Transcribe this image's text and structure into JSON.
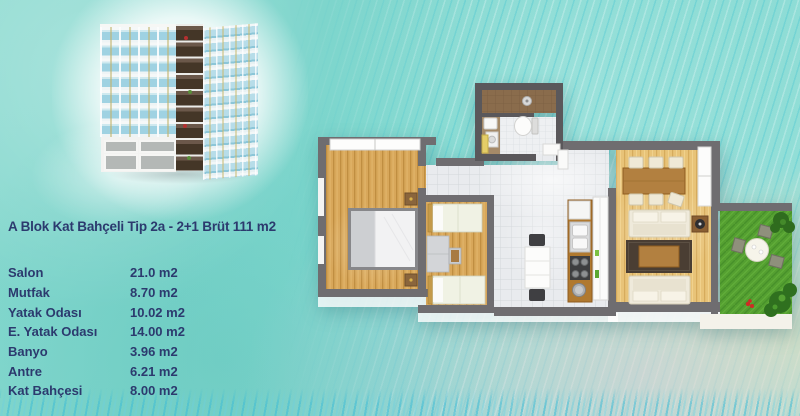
{
  "header": {
    "title": "A Blok Kat Bahçeli Tip 2a - 2+1 Brüt 111 m2"
  },
  "room_table": {
    "rows": [
      {
        "label": "Salon",
        "area": "21.0 m2"
      },
      {
        "label": "Mutfak",
        "area": "8.70 m2"
      },
      {
        "label": "Yatak Odası",
        "area": "10.02 m2"
      },
      {
        "label": "E. Yatak Odası",
        "area": "14.00 m2"
      },
      {
        "label": "Banyo",
        "area": "3.96 m2"
      },
      {
        "label": "Antre",
        "area": "6.21 m2"
      },
      {
        "label": "Kat Bahçesi",
        "area": "8.00 m2"
      }
    ]
  },
  "colors": {
    "background_teal": "#81D6CD",
    "text_navy": "#2C3A6E",
    "plan_wall_gray": "#6F6D70",
    "bathroom_wall_gray": "#5A585B",
    "wood_floor": "#D8A75A",
    "wood_floor_light": "#E8C378",
    "tile_gray": "#E9EBEE",
    "grass_green": "#55A031",
    "kitchen_counter_brown": "#B0792F",
    "accent_yellow": "#E4CD68"
  }
}
